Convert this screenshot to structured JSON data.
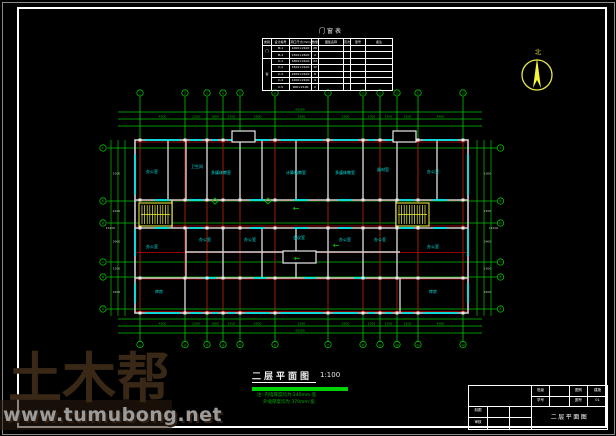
{
  "schedule": {
    "title": "门窗表",
    "headers": [
      "类别",
      "设计编号",
      "洞口尺寸(mm)",
      "数量",
      "图集名称",
      "页次",
      "型号",
      "备注"
    ],
    "col_widths": [
      9,
      18,
      22,
      7,
      25,
      7,
      15,
      27
    ],
    "groups": [
      {
        "label": "门",
        "rows": [
          [
            "M-1",
            "1000×2100",
            "28",
            "",
            "",
            "",
            ""
          ],
          [
            "M-2",
            "1500×2400",
            "2",
            "",
            "",
            "",
            ""
          ]
        ]
      },
      {
        "label": "窗",
        "rows": [
          [
            "C-1",
            "1800×2100",
            "24",
            "",
            "",
            "",
            ""
          ],
          [
            "C-2",
            "1500×2100",
            "12",
            "",
            "",
            "",
            ""
          ],
          [
            "C-3",
            "2400×2100",
            "8",
            "",
            "",
            "",
            ""
          ],
          [
            "C-4",
            "1200×2100",
            "4",
            "",
            "",
            "",
            ""
          ],
          [
            "C-5",
            "900×2100",
            "2",
            "",
            "",
            "",
            ""
          ]
        ]
      }
    ]
  },
  "compass": {
    "label": "北"
  },
  "footer": {
    "title": "二层平面图",
    "scale": "1:100",
    "note1": "注: 内墙厚度均为 240mm 宽.",
    "note2": "外墙厚度均为 370mm 宽."
  },
  "titleblock": {
    "r1": [
      "班级",
      "",
      "图别",
      "建施"
    ],
    "r2": [
      "学号",
      "",
      "图号",
      "01"
    ],
    "left1": "制图",
    "left2": "审核",
    "drawing_name": "二层平面图"
  },
  "watermark": {
    "brand": "土木帮",
    "url": "www.tumubong.net"
  },
  "plan": {
    "colors": {
      "grid": "#00c300",
      "red": "#c40000",
      "wall": "#d0d0d0",
      "cyan": "#00e5e5",
      "yellow": "#f5f53c",
      "white": "#e8e8e8",
      "bright": "#00d300"
    },
    "vx": [
      140,
      185,
      207,
      223,
      240,
      275,
      328,
      363,
      380,
      397,
      418,
      463
    ],
    "hy": [
      148,
      201,
      223,
      262,
      277,
      309
    ],
    "axis_top": [
      "1",
      "2",
      "3",
      "4",
      "5",
      "6",
      "7",
      "8",
      "9",
      "10",
      "11",
      "12"
    ],
    "axis_side": [
      "F",
      "E",
      "D",
      "C",
      "B",
      "A"
    ],
    "dim_lines": [
      [
        118,
        112,
        482,
        112
      ],
      [
        118,
        119,
        482,
        119
      ],
      [
        118,
        126,
        482,
        126
      ],
      [
        118,
        319,
        482,
        319
      ],
      [
        118,
        326,
        482,
        326
      ],
      [
        118,
        333,
        482,
        333
      ],
      [
        111,
        140,
        111,
        316
      ],
      [
        118,
        140,
        118,
        316
      ],
      [
        125,
        140,
        125,
        316
      ],
      [
        477,
        140,
        477,
        316
      ],
      [
        484,
        140,
        484,
        316
      ],
      [
        491,
        140,
        491,
        316
      ]
    ],
    "red_hy": [
      142,
      200.5,
      226,
      252.5,
      279,
      311.5
    ],
    "wall_rect": [
      135,
      140,
      333,
      173
    ],
    "wall_lines": [
      [
        135,
        200,
        468,
        200
      ],
      [
        135,
        228,
        468,
        228
      ],
      [
        185,
        252,
        400,
        252
      ],
      [
        135,
        278,
        468,
        278
      ],
      [
        168,
        140,
        168,
        200
      ],
      [
        186,
        140,
        186,
        200
      ],
      [
        207,
        140,
        207,
        200
      ],
      [
        240,
        140,
        240,
        200
      ],
      [
        262,
        140,
        262,
        200
      ],
      [
        296,
        140,
        296,
        200
      ],
      [
        328,
        140,
        328,
        200
      ],
      [
        363,
        140,
        363,
        200
      ],
      [
        397,
        140,
        397,
        200
      ],
      [
        437,
        140,
        437,
        200
      ],
      [
        186,
        228,
        186,
        278
      ],
      [
        223,
        228,
        223,
        278
      ],
      [
        262,
        228,
        262,
        278
      ],
      [
        296,
        228,
        296,
        278
      ],
      [
        328,
        228,
        328,
        278
      ],
      [
        363,
        228,
        363,
        278
      ],
      [
        397,
        228,
        397,
        278
      ],
      [
        185,
        278,
        185,
        313
      ],
      [
        400,
        278,
        400,
        313
      ],
      [
        172,
        200,
        172,
        228
      ],
      [
        396,
        200,
        396,
        228
      ]
    ],
    "win_side_pairs": [
      [
        148,
        201
      ],
      [
        223,
        262
      ],
      [
        277,
        309
      ]
    ],
    "corridor_win_x": [
      162,
      196,
      257,
      301,
      345,
      407,
      440
    ],
    "mid_win_x": [
      210,
      260,
      310,
      360
    ],
    "col_y": [
      140,
      200,
      228,
      278,
      313
    ],
    "stairs": [
      [
        139,
        203,
        33,
        23
      ],
      [
        396,
        203,
        33,
        23
      ]
    ],
    "canopies": [
      [
        232,
        131,
        23,
        11
      ],
      [
        393,
        131,
        23,
        11
      ],
      [
        283,
        251,
        33,
        12
      ]
    ],
    "arrows": [
      [
        296,
        211
      ],
      [
        336,
        248
      ],
      [
        297,
        261
      ]
    ],
    "diamonds": [
      [
        215,
        201
      ],
      [
        268,
        201
      ]
    ],
    "rooms": [
      [
        152,
        173,
        "办公室"
      ],
      [
        197,
        168,
        "卫生间"
      ],
      [
        221,
        174,
        "多媒体教室"
      ],
      [
        296,
        174,
        "计算机教室"
      ],
      [
        345,
        174,
        "多媒体教室"
      ],
      [
        383,
        171,
        "器材室"
      ],
      [
        433,
        173,
        "办公室"
      ],
      [
        152,
        248,
        "办公室"
      ],
      [
        205,
        241,
        "办公室"
      ],
      [
        250,
        241,
        "办公室"
      ],
      [
        299,
        239,
        "会议室"
      ],
      [
        345,
        241,
        "办公室"
      ],
      [
        380,
        241,
        "办公室"
      ],
      [
        433,
        248,
        "办公室"
      ],
      [
        159,
        293,
        "库房"
      ],
      [
        433,
        293,
        "库房"
      ]
    ],
    "top_dims": [
      "4500",
      "2200",
      "1600",
      "1700",
      "3500",
      "5300",
      "3500",
      "1700",
      "1700",
      "2100",
      "4500"
    ],
    "side_dims": [
      "5300",
      "2200",
      "3900",
      "1500",
      "3200"
    ],
    "totals": {
      "top": "43200",
      "bottom": "43200",
      "left": "16100",
      "right": "16100"
    }
  }
}
